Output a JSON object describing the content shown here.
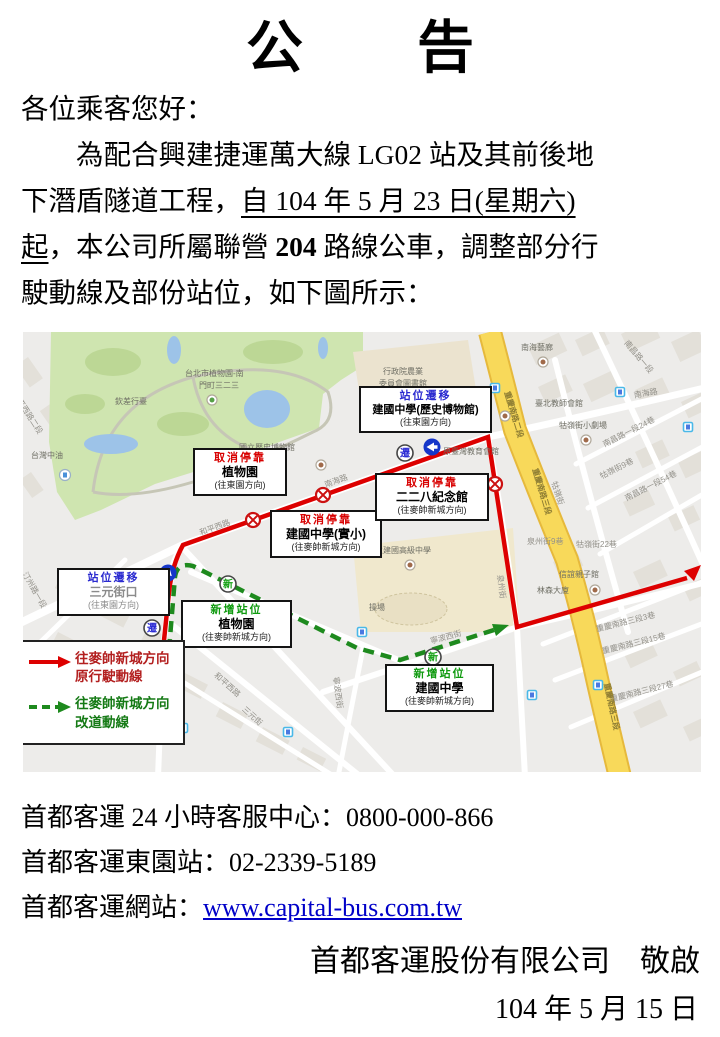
{
  "notice": {
    "title": "公　　告",
    "greeting": "各位乘客您好：",
    "body_lines": [
      [
        {
          "t": "　　為配合興建捷運萬大線 LG02 站及其前後地"
        }
      ],
      [
        {
          "t": "下潛盾隧道工程，"
        },
        {
          "t": "自 104 年 5 月 23 日(星期六)",
          "u": true
        }
      ],
      [
        {
          "t": "起",
          "u": true
        },
        {
          "t": "，本公司所屬聯營 "
        },
        {
          "t": "204",
          "b": true
        },
        {
          "t": " 路線公車，調整部分行"
        }
      ],
      [
        {
          "t": "駛動線及部份站位，如下圖所示："
        }
      ]
    ],
    "contact_line1": "首都客運 24 小時客服中心：0800-000-866",
    "contact_line2": "首都客運東園站：02-2339-5189",
    "website_label": "首都客運網站：",
    "website_url": "www.capital-bus.com.tw",
    "signature": "首都客運股份有限公司　敬啟",
    "date": "104 年 5 月 15 日"
  },
  "map": {
    "badges": {
      "move": "遷",
      "new": "新"
    },
    "colors": {
      "original_route": "#dd0000",
      "detour_route": "#1e8a1e",
      "cancel_title": "#d80000",
      "move_title": "#2b2bd0",
      "new_title": "#0f9a0f",
      "major_road": "#f8d95a",
      "park": "#cfe5b0"
    },
    "legend": {
      "items": [
        {
          "line1": "往麥帥新城方向",
          "line2": "原行駛動線",
          "style": "solid-red-arrow"
        },
        {
          "line1": "往麥帥新城方向",
          "line2": "改道動線",
          "style": "dashed-green-arrow"
        }
      ]
    },
    "callouts": [
      {
        "type": "cancel",
        "title": "取消停靠",
        "name": "植物園",
        "direction": "(往東園方向)"
      },
      {
        "type": "move",
        "title": "站位遷移",
        "name": "建國中學(歷史博物館)",
        "direction": "(往東園方向)"
      },
      {
        "type": "cancel",
        "title": "取消停靠",
        "name": "建國中學(實小)",
        "direction": "(往麥帥新城方向)"
      },
      {
        "type": "cancel",
        "title": "取消停靠",
        "name": "二二八紀念館",
        "direction": "(往麥帥新城方向)"
      },
      {
        "type": "move",
        "title": "站位遷移",
        "name": "三元街口",
        "direction": "(往東園方向)"
      },
      {
        "type": "new",
        "title": "新增站位",
        "name": "植物園",
        "direction": "(往麥帥新城方向)"
      },
      {
        "type": "new",
        "title": "新增站位",
        "name": "建國中學",
        "direction": "(往麥帥新城方向)"
      }
    ],
    "labels": [
      {
        "t": "台北市植物園-南",
        "x": 162,
        "y": 36,
        "c": "poi"
      },
      {
        "t": "門町三二三",
        "x": 176,
        "y": 48,
        "c": "poi"
      },
      {
        "t": "欽差行臺",
        "x": 92,
        "y": 64,
        "c": "poi"
      },
      {
        "t": "台灣中油",
        "x": 8,
        "y": 118,
        "c": "poi"
      },
      {
        "t": "和平西路二段",
        "x": -4,
        "y": 58,
        "r": 57,
        "c": "road"
      },
      {
        "t": "國立歷史博物館",
        "x": 216,
        "y": 110,
        "c": "poi"
      },
      {
        "t": "和平西路",
        "x": 175,
        "y": 196,
        "r": -20,
        "c": "road"
      },
      {
        "t": "南海路",
        "x": 300,
        "y": 148,
        "r": -20,
        "c": "road"
      },
      {
        "t": "行政院農業",
        "x": 360,
        "y": 34,
        "c": "poi"
      },
      {
        "t": "委員會圖書館",
        "x": 356,
        "y": 46,
        "c": "poi"
      },
      {
        "t": "原臺灣教育會館",
        "x": 420,
        "y": 114,
        "c": "poi"
      },
      {
        "t": "南海藝廊",
        "x": 498,
        "y": 10,
        "c": "poi"
      },
      {
        "t": "臺北教師會館",
        "x": 512,
        "y": 66,
        "c": "poi"
      },
      {
        "t": "牯嶺街小劇場",
        "x": 536,
        "y": 88,
        "c": "poi"
      },
      {
        "t": "南昌路一段24巷",
        "x": 578,
        "y": 108,
        "r": -27,
        "c": "road"
      },
      {
        "t": "牯嶺街9巷",
        "x": 575,
        "y": 140,
        "r": -27,
        "c": "road"
      },
      {
        "t": "南昌路一段54巷",
        "x": 600,
        "y": 162,
        "r": -27,
        "c": "road"
      },
      {
        "t": "南海路",
        "x": 610,
        "y": 58,
        "r": -10,
        "c": "road"
      },
      {
        "t": "南昌路一段",
        "x": 607,
        "y": 6,
        "r": 50,
        "c": "road"
      },
      {
        "t": "重慶南路二段",
        "x": 489,
        "y": 58,
        "r": 73,
        "c": "yroad"
      },
      {
        "t": "重慶南路三段",
        "x": 517,
        "y": 135,
        "r": 73,
        "c": "yroad"
      },
      {
        "t": "牯嶺街",
        "x": 536,
        "y": 148,
        "r": 72,
        "c": "road"
      },
      {
        "t": "泉州街9巷",
        "x": 504,
        "y": 204,
        "c": "road"
      },
      {
        "t": "牯嶺街22巷",
        "x": 553,
        "y": 207,
        "c": "road"
      },
      {
        "t": "臺北市立建國高級中學",
        "x": 328,
        "y": 213,
        "c": "poi"
      },
      {
        "t": "操場",
        "x": 346,
        "y": 270,
        "c": "poi"
      },
      {
        "t": "泉州街",
        "x": 482,
        "y": 242,
        "r": 82,
        "c": "road"
      },
      {
        "t": "寧波西街",
        "x": 406,
        "y": 304,
        "r": -15,
        "c": "road"
      },
      {
        "t": "信誼親子館",
        "x": 536,
        "y": 237,
        "c": "poi"
      },
      {
        "t": "林森大廈",
        "x": 514,
        "y": 253,
        "c": "poi"
      },
      {
        "t": "重慶南路三段3巷",
        "x": 572,
        "y": 292,
        "r": -14,
        "c": "road"
      },
      {
        "t": "重慶南路三段15巷",
        "x": 578,
        "y": 314,
        "r": -14,
        "c": "road"
      },
      {
        "t": "重慶南路三段27巷",
        "x": 586,
        "y": 362,
        "r": -14,
        "c": "road"
      },
      {
        "t": "重慶南路三段",
        "x": 589,
        "y": 350,
        "r": 78,
        "c": "yroad"
      },
      {
        "t": "和平西路",
        "x": 196,
        "y": 338,
        "r": 42,
        "c": "road"
      },
      {
        "t": "三元街",
        "x": 224,
        "y": 372,
        "r": 42,
        "c": "road"
      },
      {
        "t": "汀州路一段",
        "x": 6,
        "y": 238,
        "r": 60,
        "c": "road"
      },
      {
        "t": "寧波西街",
        "x": 318,
        "y": 344,
        "r": 82,
        "c": "road"
      }
    ]
  }
}
